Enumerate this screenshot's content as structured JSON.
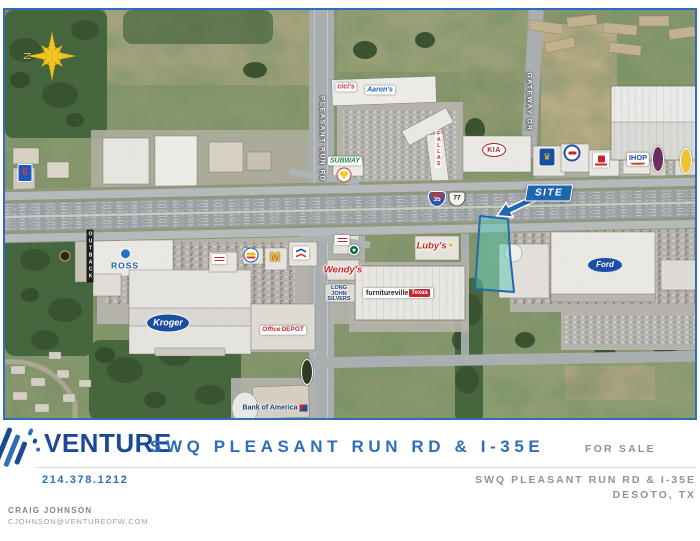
{
  "flyer": {
    "brand": "VENTURE",
    "headline": "SWQ PLEASANT RUN RD & I-35E",
    "sale_status": "FOR SALE",
    "phone": "214.378.1212",
    "property_name": "SWQ PLEASANT RUN RD & I-35E",
    "property_city": "DESOTO, TX",
    "contact": {
      "name": "CRAIG JOHNSON",
      "email": "CJOHNSON@VENTUREDFW.COM"
    }
  },
  "map": {
    "north_label": "N",
    "site_label": "SITE",
    "markers": [
      {
        "name": "pleasant-run-rd-label",
        "kind": "roadlabel",
        "x": 316,
        "y": 129,
        "text": "PLEASANT RUN RD"
      },
      {
        "name": "gateway-dr-label",
        "kind": "roadlabel",
        "x": 523,
        "y": 92,
        "text": "GATEWAY DR"
      },
      {
        "name": "interstate-35-shield",
        "kind": "i35",
        "x": 432,
        "y": 189,
        "text": "35"
      },
      {
        "name": "us-77-shield",
        "kind": "us77",
        "x": 452,
        "y": 189,
        "text": "77"
      },
      {
        "name": "cicis-pizza-logo",
        "kind": "pill",
        "x": 341,
        "y": 77,
        "text": "cici's",
        "color": "#d42d26"
      },
      {
        "name": "aarons-logo",
        "kind": "pill",
        "x": 375,
        "y": 80,
        "text": "Aaron's",
        "color": "#1b5fb8"
      },
      {
        "name": "subway-logo",
        "kind": "pill",
        "x": 340,
        "y": 151,
        "text": "SUBWAY",
        "color": "#1e8a3c"
      },
      {
        "name": "shell-logo",
        "kind": "shell",
        "x": 339,
        "y": 165
      },
      {
        "name": "fallas-store-sign",
        "kind": "vtext",
        "x": 433,
        "y": 139,
        "text": "FALLAS",
        "color": "#cf2a24"
      },
      {
        "name": "kia-logo",
        "kind": "kia",
        "x": 489,
        "y": 140,
        "text": "KIA"
      },
      {
        "name": "best-western-logo",
        "kind": "bw",
        "x": 542,
        "y": 147
      },
      {
        "name": "circular-restaurant-badge",
        "kind": "badge",
        "x": 567,
        "y": 143
      },
      {
        "name": "red-box-restaurant-sign",
        "kind": "redbox",
        "x": 596,
        "y": 150
      },
      {
        "name": "ihop-logo",
        "kind": "ihop",
        "x": 633,
        "y": 149,
        "text": "IHOP",
        "color": "#1f4fa0"
      },
      {
        "name": "dark-oval-sign",
        "kind": "voval",
        "x": 653,
        "y": 149,
        "bg": "#6b2d62"
      },
      {
        "name": "yellow-oval-sign",
        "kind": "voval",
        "x": 681,
        "y": 151,
        "bg": "#f2c233"
      },
      {
        "name": "motel6-logo",
        "kind": "motel6",
        "x": 20,
        "y": 163,
        "text": "6"
      },
      {
        "name": "round-restaurant-badge",
        "kind": "badge2",
        "x": 60,
        "y": 246
      },
      {
        "name": "outback-steakhouse-sign",
        "kind": "outback",
        "x": 85,
        "y": 246,
        "text": "OUTBACK"
      },
      {
        "name": "ross-logo",
        "kind": "ross",
        "x": 120,
        "y": 249,
        "text": "ROSS"
      },
      {
        "name": "small-restaurant-sign",
        "kind": "smallsign",
        "x": 214,
        "y": 249
      },
      {
        "name": "burger-king-logo",
        "kind": "bk",
        "x": 246,
        "y": 245
      },
      {
        "name": "mcdonalds-logo",
        "kind": "mcd",
        "x": 270,
        "y": 247,
        "text": "M"
      },
      {
        "name": "chevron-logo",
        "kind": "chevron",
        "x": 296,
        "y": 243
      },
      {
        "name": "small-cafe-sign",
        "kind": "smallsign",
        "x": 337,
        "y": 230
      },
      {
        "name": "starbucks-logo",
        "kind": "sbux",
        "x": 349,
        "y": 240
      },
      {
        "name": "lubys-logo",
        "kind": "lubys",
        "x": 430,
        "y": 236,
        "text": "Luby's",
        "color": "#c62b1f"
      },
      {
        "name": "wendys-logo",
        "kind": "script",
        "x": 338,
        "y": 260,
        "text": "Wendy's",
        "color": "#d51f27"
      },
      {
        "name": "long-john-silvers-logo",
        "kind": "ljs",
        "x": 334,
        "y": 284,
        "text": "LONG JOHN SILVERS"
      },
      {
        "name": "furnitureville-banner",
        "kind": "furn",
        "x": 393,
        "y": 283,
        "text": "furnitureville",
        "text2": "Texas"
      },
      {
        "name": "kroger-logo",
        "kind": "kroger",
        "x": 163,
        "y": 313,
        "text": "Kroger"
      },
      {
        "name": "office-depot-logo",
        "kind": "od",
        "x": 278,
        "y": 320,
        "text": "Office",
        "text2": "DEPOT"
      },
      {
        "name": "dark-oval-restaurant-sign",
        "kind": "voval",
        "x": 302,
        "y": 362,
        "bg": "#2d3a22"
      },
      {
        "name": "bank-of-america-logo",
        "kind": "boa",
        "x": 270,
        "y": 398,
        "text": "Bank of America"
      },
      {
        "name": "ford-dealership-logo",
        "kind": "ford",
        "x": 600,
        "y": 255,
        "text": "Ford"
      }
    ]
  },
  "colors": {
    "brand_navy": "#1a4a96",
    "accent_blue": "#2e6db8",
    "site_outline_blue": "#1f66b0",
    "site_fill_teal": "#56c9b4",
    "muted_gray": "#8c9196"
  }
}
